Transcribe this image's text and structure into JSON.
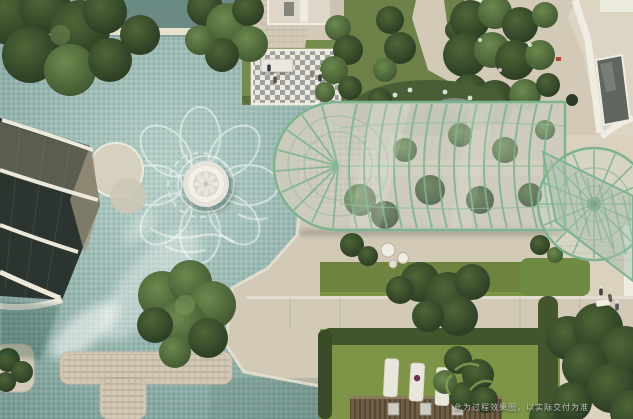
{
  "watermark": {
    "disclaimer": "此为过程效果图，以实际交付为准"
  },
  "palette": {
    "pavement": "#d2c9b6",
    "pavementLight": "#dcd4c2",
    "poolBase": "#9cb9b3",
    "poolDeep": "#63827d",
    "poolLight": "#bad2ca",
    "coping": "#e6e0cf",
    "grass": "#768b4e",
    "lawn": "#7e9447",
    "hedge": "#42552c",
    "treeDark": "#2f4126",
    "treeMid": "#53703c",
    "glassRib": "#7db38e",
    "glassFill": "rgba(206,219,209,0.32)",
    "whiteTrim": "#efece2",
    "wood": "#6f5d45",
    "glazingDark": "#2b342e",
    "checkerGray": "#a0a09a",
    "skylight": "#5f665e",
    "watermark": "#c9ccc3"
  },
  "scene": {
    "type": "aerial-courtyard-rendering",
    "elements": [
      "swimming-pool",
      "lotus-fountain",
      "pool-floor-flower-motif",
      "pool-islands",
      "glass-conservatory-tunnel",
      "glass-dome",
      "glass-wing",
      "checkered-plaza",
      "pergola-table",
      "residential-tower",
      "top-right-villa",
      "pond-garden",
      "shrub-garden",
      "lawn",
      "hedges",
      "sun-mats",
      "wood-pergola-deck",
      "stepping-walkway",
      "stone-walkways",
      "people"
    ]
  }
}
